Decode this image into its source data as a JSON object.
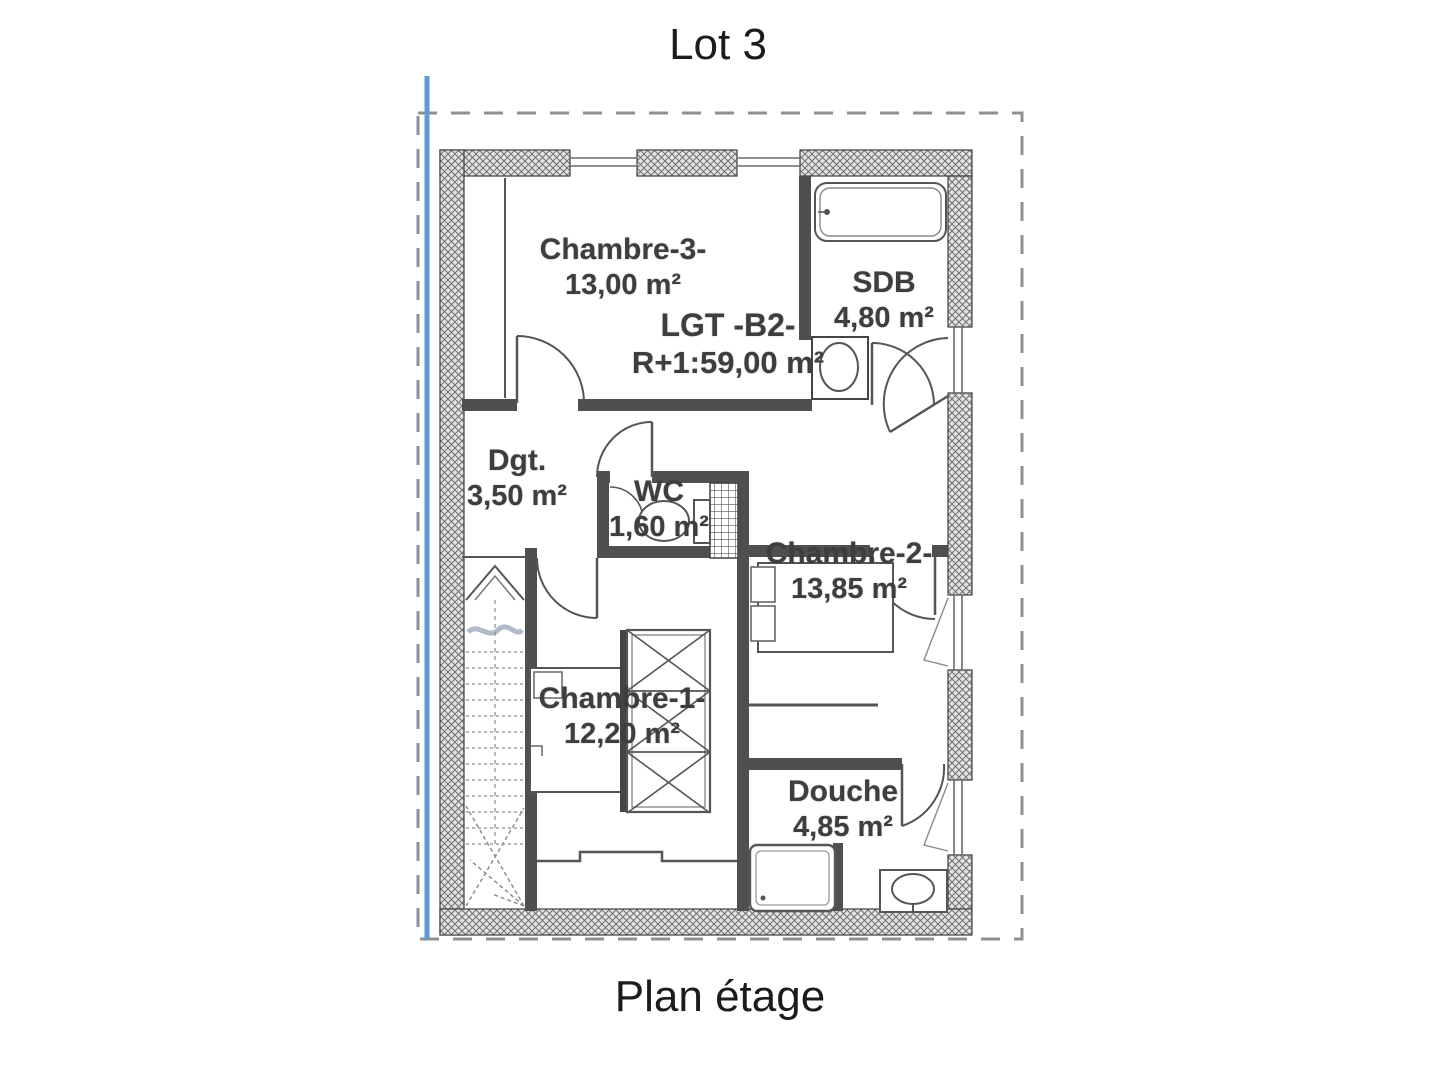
{
  "page": {
    "title": "Lot 3",
    "caption": "Plan étage"
  },
  "rooms": [
    {
      "id": "chambre-3",
      "name": "Chambre-3-",
      "area": "13,00 m²"
    },
    {
      "id": "lgt-b2",
      "name": "LGT -B2-",
      "area": "R+1:59,00 m²"
    },
    {
      "id": "sdb",
      "name": "SDB",
      "area": "4,80 m²"
    },
    {
      "id": "dgt",
      "name": "Dgt.",
      "area": "3,50 m²"
    },
    {
      "id": "wc",
      "name": "WC",
      "area": "1,60 m²"
    },
    {
      "id": "chambre-2",
      "name": "Chambre-2-",
      "area": "13,85 m²"
    },
    {
      "id": "chambre-1",
      "name": "Chambre-1-",
      "area": "12,20 m²"
    },
    {
      "id": "douche",
      "name": "Douche",
      "area": "4,85 m²"
    }
  ],
  "colors": {
    "accent_blue_line": "#5b9cd5",
    "dashed_boundary": "#909090",
    "wall_dark": "#4f4f4f",
    "label_text": "#3e3e3e"
  }
}
